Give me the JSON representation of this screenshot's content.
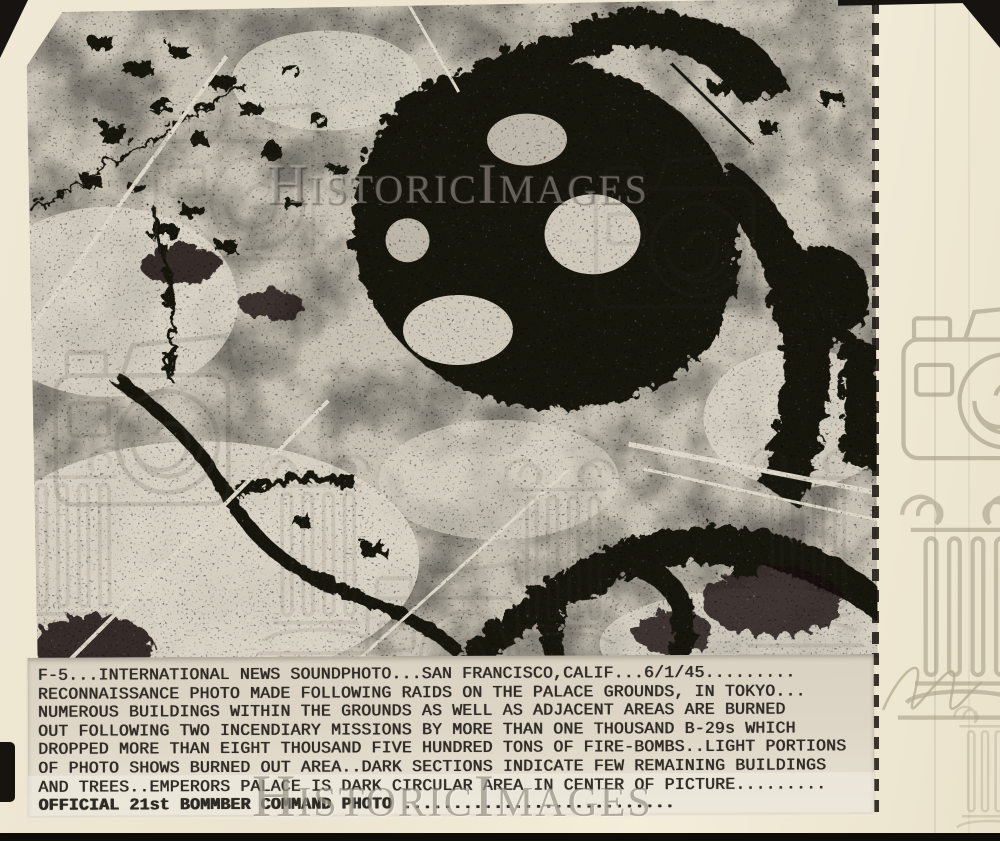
{
  "watermark": {
    "text": "HistoricImages"
  },
  "caption": {
    "lines": [
      "F-5...INTERNATIONAL NEWS SOUNDPHOTO...SAN FRANCISCO,CALIF...6/1/45.........",
      "RECONNAISSANCE PHOTO MADE FOLLOWING RAIDS ON THE PALACE GROUNDS, IN TOKYO...",
      "NUMEROUS BUILDINGS WITHIN THE GROUNDS AS WELL AS ADJACENT AREAS ARE BURNED",
      "OUT FOLLOWING TWO INCENDIARY MISSIONS BY MORE THAN ONE THOUSAND B-29s WHICH",
      "DROPPED MORE THAN EIGHT THOUSAND FIVE HUNDRED TONS OF FIRE-BOMBS..LIGHT PORTIONS",
      "OF PHOTO SHOWS BURNED OUT AREA..DARK SECTIONS INDICATE FEW REMAINING BUILDINGS",
      "AND TREES..EMPERORS PALACE IS DARK CIRCULAR AREA IN CENTER OF PICTURE.........",
      "OFFICIAL 21st BOMMBER COMMAND PHOTO ..........................."
    ]
  },
  "icons": [
    "camera-icon",
    "pillar-icon",
    "handwriting-mark"
  ],
  "colors": {
    "paper": "#eee7d3",
    "caption_paper": "#ddd6c6",
    "photo_light": "#c7c1b3",
    "photo_dark": "#16130e",
    "typed_ink": "#2e2a25",
    "watermark_gray": "#8d8574",
    "scanner_bg": "#14110d"
  }
}
